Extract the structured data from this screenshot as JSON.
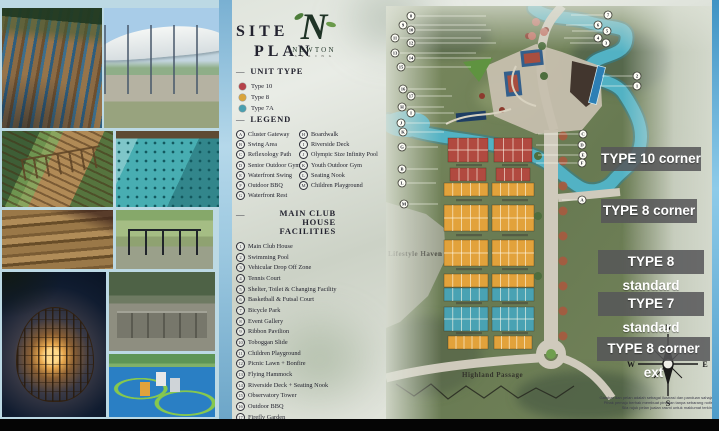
{
  "slide": {
    "dash": "—",
    "title_line1": "SITE",
    "title_line2": "PLAN",
    "logo": {
      "letter": "N",
      "name": "NEWTON",
      "tagline": "S P R I N G"
    }
  },
  "unit_type": {
    "header": "UNIT TYPE",
    "items": [
      {
        "label": "Type 10",
        "color": "#b5424a"
      },
      {
        "label": "Type 8",
        "color": "#d9a43b"
      },
      {
        "label": "Type 7A",
        "color": "#4a9fb0"
      }
    ]
  },
  "legend": {
    "header": "LEGEND",
    "items": [
      {
        "key": "A",
        "label": "Cluster Gateway"
      },
      {
        "key": "B",
        "label": "Swing Area"
      },
      {
        "key": "C",
        "label": "Reflexology Path"
      },
      {
        "key": "D",
        "label": "Senior Outdoor Gym"
      },
      {
        "key": "E",
        "label": "Waterfront Swing"
      },
      {
        "key": "F",
        "label": "Outdoor BBQ"
      },
      {
        "key": "G",
        "label": "Waterfront Rest"
      },
      {
        "key": "H",
        "label": "Boardwalk"
      },
      {
        "key": "I",
        "label": "Riverside Deck"
      },
      {
        "key": "J",
        "label": "Olympic Size Infinity Pool"
      },
      {
        "key": "K",
        "label": "Youth Outdoor Gym"
      },
      {
        "key": "L",
        "label": "Seating Nook"
      },
      {
        "key": "M",
        "label": "Children Playground"
      }
    ]
  },
  "facilities": {
    "header_line1": "MAIN CLUB HOUSE",
    "header_line2": "FACILITIES",
    "items": [
      {
        "num": "1",
        "label": "Main Club House"
      },
      {
        "num": "2",
        "label": "Swimming Pool"
      },
      {
        "num": "3",
        "label": "Vehicular Drop Off Zone"
      },
      {
        "num": "4",
        "label": "Tennis Court"
      },
      {
        "num": "5",
        "label": "Shelter, Toilet & Changing Facility"
      },
      {
        "num": "6",
        "label": "Basketball & Futsal Court"
      },
      {
        "num": "7",
        "label": "Bicycle Park"
      },
      {
        "num": "8",
        "label": "Event Gallery"
      },
      {
        "num": "9",
        "label": "Ribbon Pavilion"
      },
      {
        "num": "10",
        "label": "Toboggan Slide"
      },
      {
        "num": "11",
        "label": "Children Playground"
      },
      {
        "num": "12",
        "label": "Picnic Lawn + Bonfire"
      },
      {
        "num": "13",
        "label": "Flying Hammock"
      },
      {
        "num": "14",
        "label": "Riverside Deck + Seating Nook"
      },
      {
        "num": "15",
        "label": "Observatory Tower"
      },
      {
        "num": "16",
        "label": "Outdoor BBQ"
      },
      {
        "num": "17",
        "label": "Firefly Garden"
      }
    ]
  },
  "map": {
    "labels": {
      "lifestyle_haven": "Lifestyle Haven",
      "highland_passage": "Highland Passage"
    },
    "lot_colors": {
      "red": "#b14a40",
      "yellow": "#e2a23b",
      "teal": "#49a2b3"
    },
    "blocks": [
      {
        "x": 62,
        "y": 132,
        "w": 40,
        "h": 24,
        "rows": 2,
        "cols": 4,
        "c": "red"
      },
      {
        "x": 108,
        "y": 132,
        "w": 38,
        "h": 24,
        "rows": 2,
        "cols": 4,
        "c": "red"
      },
      {
        "x": 64,
        "y": 162,
        "w": 36,
        "h": 13,
        "rows": 1,
        "cols": 4,
        "c": "red"
      },
      {
        "x": 110,
        "y": 162,
        "w": 34,
        "h": 13,
        "rows": 1,
        "cols": 4,
        "c": "red"
      },
      {
        "x": 58,
        "y": 177,
        "w": 44,
        "h": 13,
        "rows": 1,
        "cols": 5,
        "c": "yellow"
      },
      {
        "x": 106,
        "y": 177,
        "w": 42,
        "h": 13,
        "rows": 1,
        "cols": 5,
        "c": "yellow"
      },
      {
        "x": 58,
        "y": 199,
        "w": 44,
        "h": 26,
        "rows": 2,
        "cols": 5,
        "c": "yellow"
      },
      {
        "x": 106,
        "y": 199,
        "w": 42,
        "h": 26,
        "rows": 2,
        "cols": 5,
        "c": "yellow"
      },
      {
        "x": 58,
        "y": 234,
        "w": 44,
        "h": 26,
        "rows": 2,
        "cols": 5,
        "c": "yellow"
      },
      {
        "x": 106,
        "y": 234,
        "w": 42,
        "h": 26,
        "rows": 2,
        "cols": 5,
        "c": "yellow"
      },
      {
        "x": 58,
        "y": 268,
        "w": 44,
        "h": 13,
        "rows": 1,
        "cols": 5,
        "c": "yellow"
      },
      {
        "x": 106,
        "y": 268,
        "w": 42,
        "h": 13,
        "rows": 1,
        "cols": 5,
        "c": "yellow"
      },
      {
        "x": 58,
        "y": 282,
        "w": 44,
        "h": 13,
        "rows": 1,
        "cols": 5,
        "c": "teal"
      },
      {
        "x": 106,
        "y": 282,
        "w": 42,
        "h": 13,
        "rows": 1,
        "cols": 5,
        "c": "teal"
      },
      {
        "x": 58,
        "y": 301,
        "w": 44,
        "h": 24,
        "rows": 2,
        "cols": 5,
        "c": "teal"
      },
      {
        "x": 106,
        "y": 301,
        "w": 42,
        "h": 24,
        "rows": 2,
        "cols": 5,
        "c": "teal"
      },
      {
        "x": 62,
        "y": 330,
        "w": 40,
        "h": 13,
        "rows": 1,
        "cols": 5,
        "c": "yellow"
      },
      {
        "x": 108,
        "y": 330,
        "w": 38,
        "h": 13,
        "rows": 1,
        "cols": 5,
        "c": "yellow"
      }
    ],
    "callouts_left": [
      {
        "label": "8",
        "x": 25,
        "y": 10,
        "x2": 100
      },
      {
        "label": "9",
        "x": 17,
        "y": 19,
        "x2": 100
      },
      {
        "label": "10",
        "x": 25,
        "y": 24,
        "x2": 105
      },
      {
        "label": "11",
        "x": 9,
        "y": 32,
        "x2": 95
      },
      {
        "label": "12",
        "x": 25,
        "y": 37,
        "x2": 110
      },
      {
        "label": "13",
        "x": 9,
        "y": 47,
        "x2": 90
      },
      {
        "label": "14",
        "x": 25,
        "y": 52,
        "x2": 105
      },
      {
        "label": "15",
        "x": 15,
        "y": 61,
        "x2": 85
      },
      {
        "label": "16",
        "x": 17,
        "y": 83,
        "x2": 60
      },
      {
        "label": "17",
        "x": 25,
        "y": 90,
        "x2": 66
      },
      {
        "label": "H",
        "x": 16,
        "y": 101,
        "x2": 58
      },
      {
        "label": "I",
        "x": 25,
        "y": 107,
        "x2": 68
      },
      {
        "label": "J",
        "x": 15,
        "y": 117,
        "x2": 62
      },
      {
        "label": "K",
        "x": 17,
        "y": 126,
        "x2": 58
      },
      {
        "label": "G",
        "x": 16,
        "y": 141,
        "x2": 52
      },
      {
        "label": "B",
        "x": 16,
        "y": 163,
        "x2": 52
      },
      {
        "label": "L",
        "x": 16,
        "y": 177,
        "x2": 50
      },
      {
        "label": "M",
        "x": 18,
        "y": 198,
        "x2": 52
      }
    ],
    "callouts_right": [
      {
        "label": "7",
        "x": 222,
        "y": 9,
        "x2": 185
      },
      {
        "label": "6",
        "x": 212,
        "y": 19,
        "x2": 180
      },
      {
        "label": "5",
        "x": 221,
        "y": 25,
        "x2": 186
      },
      {
        "label": "4",
        "x": 212,
        "y": 32,
        "x2": 178
      },
      {
        "label": "3",
        "x": 220,
        "y": 37,
        "x2": 184
      },
      {
        "label": "2",
        "x": 251,
        "y": 70,
        "x2": 216
      },
      {
        "label": "1",
        "x": 251,
        "y": 80,
        "x2": 214
      },
      {
        "label": "C",
        "x": 197,
        "y": 128,
        "x2": 152
      },
      {
        "label": "D",
        "x": 196,
        "y": 139,
        "x2": 150
      },
      {
        "label": "E",
        "x": 197,
        "y": 149,
        "x2": 152
      },
      {
        "label": "F",
        "x": 196,
        "y": 157,
        "x2": 150
      },
      {
        "label": "A",
        "x": 196,
        "y": 194,
        "x2": 176
      }
    ]
  },
  "type_labels": [
    {
      "text": "TYPE 10 corner",
      "top": 147,
      "left": 601,
      "w": 100
    },
    {
      "text": "TYPE 8 corner",
      "top": 199,
      "left": 601,
      "w": 96
    },
    {
      "text": "TYPE 8 standard",
      "top": 250,
      "left": 598,
      "w": 106
    },
    {
      "text": "TYPE 7 standard",
      "top": 292,
      "left": 598,
      "w": 106
    },
    {
      "text": "TYPE 8 corner ext",
      "top": 337,
      "left": 597,
      "w": 113
    }
  ],
  "compass": {
    "n": "N",
    "e": "E",
    "s": "S",
    "w": "W"
  },
  "disclaimer": {
    "line1": "Gambar dan pelan adalah sebagai ilustrasi dan panduan sahaja.",
    "line2": "Pihak pemaju berhak membuat pindaan tanpa sebarang notis.",
    "line3": "Sila rujuk pelan jualan rasmi untuk maklumat terkini."
  }
}
